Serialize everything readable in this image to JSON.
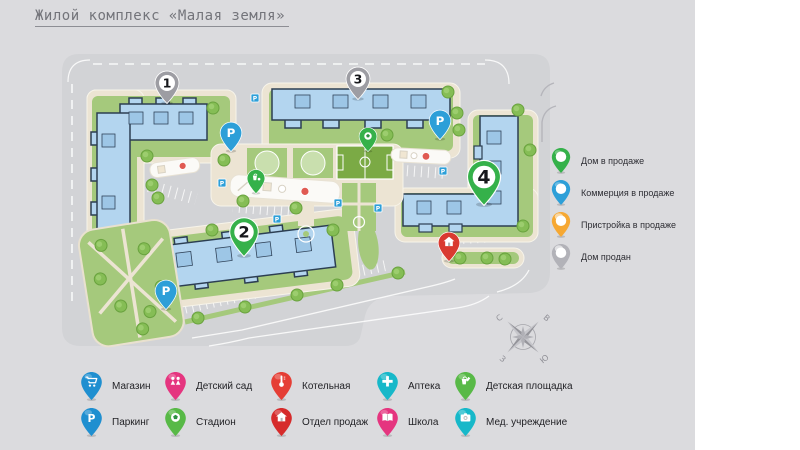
{
  "slide": {
    "title": "Жилой комплекс «Малая земля»"
  },
  "map": {
    "parking_label": "P",
    "building_pins": [
      {
        "number": "1",
        "status": "Дом продан",
        "color": "#9d9da3"
      },
      {
        "number": "2",
        "status": "Дом в продаже",
        "color": "#35b14a"
      },
      {
        "number": "3",
        "status": "Дом продан",
        "color": "#9d9da3"
      },
      {
        "number": "4",
        "status": "Дом в продаже",
        "color": "#35b14a"
      }
    ],
    "poi_pins": [
      {
        "icon": "soccer-ball-icon",
        "color": "#35b14a",
        "meaning": "Стадион"
      },
      {
        "icon": "playground-icon",
        "color": "#35b14a",
        "meaning": "Детская площадка"
      },
      {
        "icon": "house-icon",
        "color": "#d93a30",
        "meaning": "Отдел продаж"
      },
      {
        "icon": "parking-icon",
        "color": "#2d9fd8",
        "meaning": "Паркинг"
      }
    ],
    "palette": {
      "road": "#d2d3d6",
      "parcel": "#ece4d3",
      "lawn": "#a5c97c",
      "building": "#b3d5ef",
      "building_outline": "#2c3e52",
      "field": "#7baa45"
    }
  },
  "status_legend": {
    "items": [
      {
        "label": "Дом в продаже",
        "color": "#35b14a"
      },
      {
        "label": "Коммерция в продаже",
        "color": "#2d9fd8"
      },
      {
        "label": "Пристройка в продаже",
        "color": "#f6a833"
      },
      {
        "label": "Дом продан",
        "color": "#b2b2b8"
      }
    ]
  },
  "compass": {
    "north": "С",
    "east": "В",
    "south": "Ю",
    "west": "З"
  },
  "poi_legend": {
    "items": [
      {
        "label": "Магазин",
        "color": "#1f8fd0",
        "icon": "cart-icon"
      },
      {
        "label": "Детский сад",
        "color": "#e5357f",
        "icon": "children-icon"
      },
      {
        "label": "Котельная",
        "color": "#e53e35",
        "icon": "thermometer-icon"
      },
      {
        "label": "Аптека",
        "color": "#17b8c9",
        "icon": "medical-cross-icon"
      },
      {
        "label": "Детская площадка",
        "color": "#58b947",
        "icon": "playground-icon"
      },
      {
        "label": "Паркинг",
        "color": "#1f8fd0",
        "icon": "parking-icon"
      },
      {
        "label": "Стадион",
        "color": "#58b947",
        "icon": "soccer-ball-icon"
      },
      {
        "label": "Отдел продаж",
        "color": "#d62b2b",
        "icon": "house-icon"
      },
      {
        "label": "Школа",
        "color": "#e5357f",
        "icon": "book-icon"
      },
      {
        "label": "Мед. учреждение",
        "color": "#17b8c9",
        "icon": "camera-icon"
      }
    ]
  }
}
